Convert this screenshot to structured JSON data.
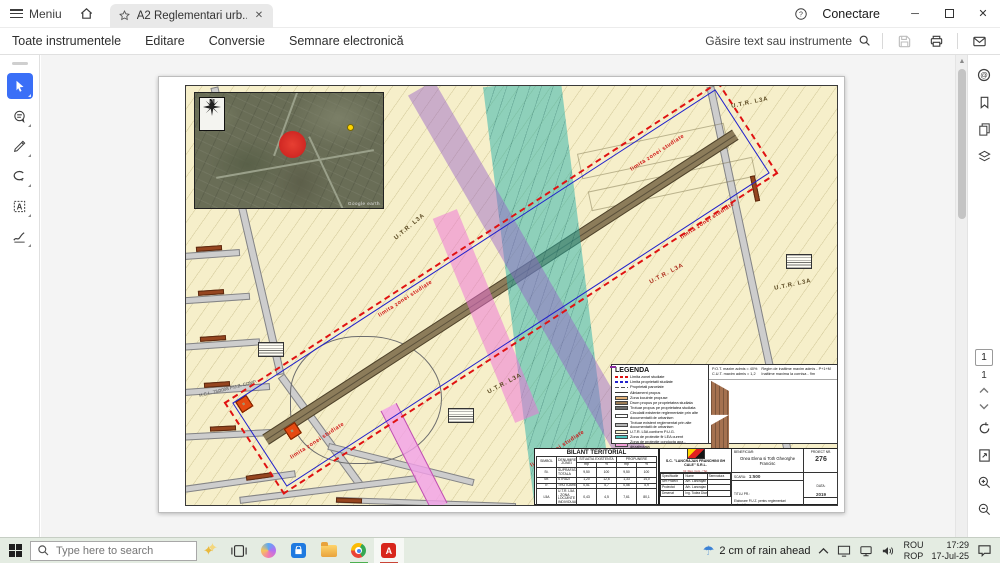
{
  "titlebar": {
    "menu_label": "Meniu",
    "tab_title": "A2 Reglementari urb...",
    "connect_label": "Conectare"
  },
  "menubar": {
    "items": [
      "Toate instrumentele",
      "Editare",
      "Conversie",
      "Semnare electronică"
    ],
    "search_label": "Găsire text sau instrumente"
  },
  "left_toolbar": {
    "tools": [
      "select",
      "add-comment",
      "draw",
      "lasso",
      "add-text",
      "fill-sign"
    ]
  },
  "right_toolbar": {
    "icons": [
      "comments",
      "bookmarks",
      "page-thumbnails",
      "layers"
    ],
    "page_current": "1",
    "page_total": "1"
  },
  "document": {
    "labels": {
      "utr": "U.T.R. L3A",
      "limita": "limita zonei studiate",
      "hcl": "H.C.L. 73/2008 P.U.Z. COMP.",
      "north": "N",
      "google": "Google earth"
    },
    "strip": {
      "lots_top": 20,
      "lots_bottom": 18,
      "empty_top": [
        18,
        19
      ],
      "empty_bottom": [
        0,
        16,
        17
      ],
      "gray_bottom": [
        15
      ]
    },
    "legend": {
      "title": "LEGENDA",
      "items": [
        {
          "type": "line-red",
          "label": "Limita zonei studiate"
        },
        {
          "type": "line-blue",
          "label": "Limita proprietatii studiate"
        },
        {
          "type": "line-gray",
          "label": "Proprietati parcelate"
        },
        {
          "type": "line-black",
          "label": "Aliniament propus"
        },
        {
          "type": "fill",
          "color": "#e2b27a",
          "label": "Zona locuinte propuse"
        },
        {
          "type": "fill",
          "color": "#9b7b55",
          "label": "Drum propus pe proprietatea studiata"
        },
        {
          "type": "fill",
          "color": "#6e6e6e",
          "label": "Trotuar propus pe proprietatea studiata"
        },
        {
          "type": "fill",
          "color": "#ffffff",
          "label": "Circulatii existente reglementate prin alte documentatii de urbanism"
        },
        {
          "type": "fill",
          "color": "#b5b5b5",
          "label": "Trotuar existent reglementat prin alte documentatii de urbanism"
        },
        {
          "type": "fill",
          "color": "#f7f3d2",
          "label": "U.T.R. L5A conform P.U.G."
        },
        {
          "type": "fill",
          "color": "#4fc8c0",
          "label": "Zona de protectie fir LEA curent"
        },
        {
          "type": "fill",
          "color": "#f2a0d8",
          "label": "Zona de protectie conducta apa - dezafectata"
        },
        {
          "type": "fill",
          "color": "#f8c8ea",
          "label": "Zona interzisa construirii pana la avizarea de catre administratorul retelei de curent electric"
        }
      ],
      "pot": "P.O.T. maxim admis = 40%",
      "cut": "C.U.T. maxim admis = 1,2",
      "regim": "Regim de inaltime maxim admis - P+1+M",
      "inaltime": "Inaltime maxima la cornisa - 9m",
      "section_label": "SECTIUNE S - S",
      "section_scale": "SCARA 1 : 100",
      "dim_left": "3m",
      "dim_mid": "7m",
      "dim_right": "3m",
      "trotuar": "trotuar",
      "carosabil": "carosabil"
    },
    "bilant": {
      "title": "BILANT TERITORIAL",
      "col_simbol": "SIMBOL",
      "col_denumire": "DENUMIREA ZONEI",
      "col_existent": "SITUATIA EXISTENTA",
      "col_propus": "PROPUNERE",
      "col_mp": "mp",
      "col_pc": "%",
      "rows": [
        [
          "St.",
          "SUPRAFATA TOTALA",
          "9,50",
          "100",
          "9,50",
          "100"
        ],
        [
          "Str.",
          "STRAZI",
          "1,20",
          "12,6",
          "1,33",
          "14,0"
        ],
        [
          "Tr.",
          "TROTUARE",
          "0,51",
          "5,7",
          "0,56",
          "5,9"
        ],
        [
          "L5A",
          "U.T.R. L5A - ZONA LOCUINTE INDIVIDUALE",
          "0,43",
          "4,5",
          "7,61",
          "80,1"
        ],
        [
          "TA",
          "TEREN AGRICOL",
          "7,36",
          "77,2",
          "-",
          "-"
        ]
      ]
    },
    "cartus": {
      "firma": "S.C. \"LANCRAJAN FRANCHINI GH CALE\" S.R.L.",
      "firma_sub": "Nr. Reg. Com. / Tel.",
      "beneficiar_label": "BENEFICIAR:",
      "beneficiar": "Onea Elena si Toth Gheorghe Francisc",
      "proiect_label": "PROIECT NR.",
      "proiect_nr": "276",
      "spec_head": [
        "Specificatie",
        "Nume",
        "Semnatura"
      ],
      "spec_rows": [
        [
          "Sef Proiect",
          "Arh. Lancrajan F.Gh."
        ],
        [
          "Proiectat",
          "Arh. Lancrajan N.Radu"
        ],
        [
          "Desenat",
          "Ing. Todea Diana"
        ]
      ],
      "scara_label": "SCARA:",
      "scara": "1:500",
      "titlu_label": "TITLU PR.:",
      "titlu": "Elaborare P.U.Z. pentru reglementari urbanistice",
      "den_label": "DEN. PL.:",
      "den": "REGLEMENTARI URBANISTICE - Zonificare",
      "data_label": "DATA:",
      "data": "2019",
      "faza_label": "FAZA:",
      "faza": "P.U.Z.",
      "plansa_label": "PLANSA NR.",
      "plansa": "A2"
    }
  },
  "taskbar": {
    "search_placeholder": "Type here to search",
    "weather": "2 cm of rain ahead",
    "lang_top": "ROU",
    "lang_bottom": "ROP",
    "time": "17:29",
    "date": "17-Jul-25"
  },
  "colors": {
    "accent_blue": "#3a6ff7",
    "boundary_red": "#e01212",
    "property_blue": "#2020cc",
    "lot_yellow": "#f1e28c",
    "house_orange": "#e54a11",
    "band_teal": "#26b2aa",
    "band_purple": "#945ec8",
    "band_pink": "#ee6ed7",
    "sheet_cream": "#f6efca"
  }
}
